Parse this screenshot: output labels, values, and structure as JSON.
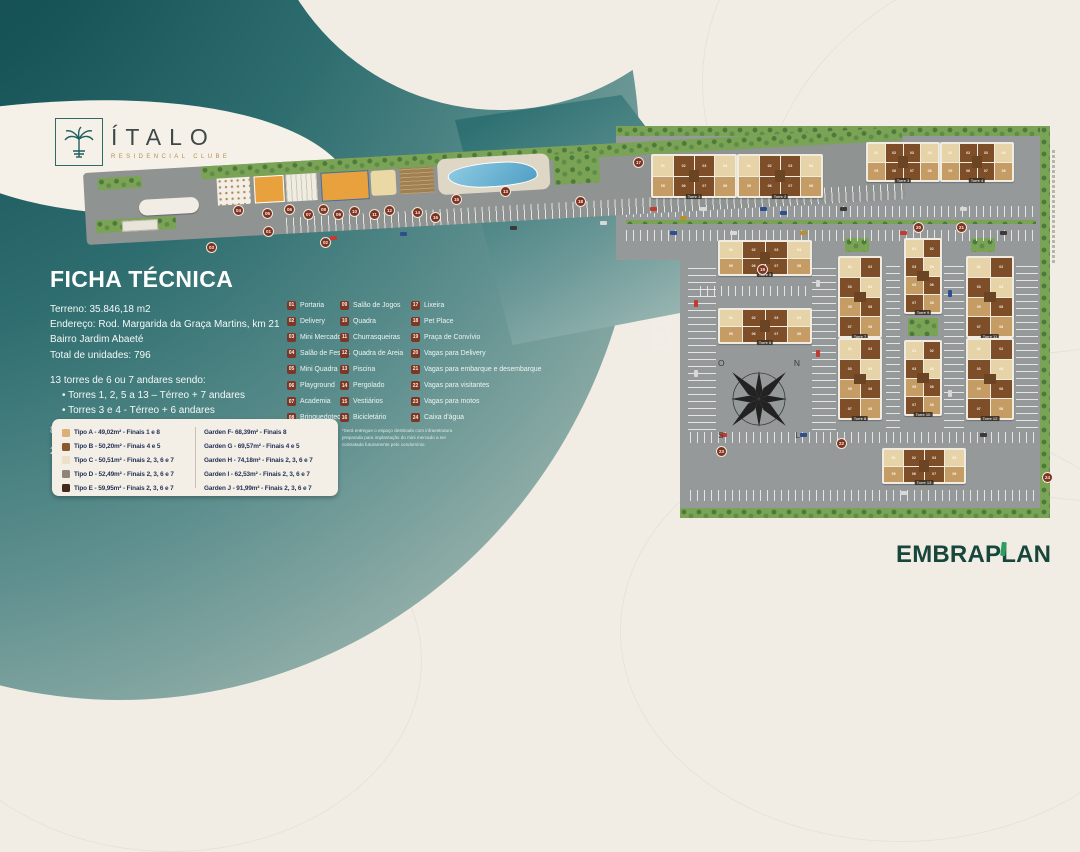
{
  "branding": {
    "title": "ÍTALO",
    "subtitle": "RESIDENCIAL CLUBE",
    "developer": "EMBRAPLAN"
  },
  "watermark": {
    "brand": "SMAGNO",
    "tagline": "Home Br"
  },
  "ficha": {
    "title": "FICHA TÉCNICA",
    "lines": [
      "Terreno: 35.846,18 m2",
      "Endereço: Rod. Margarida da Graça Martins, km 21",
      "Bairro Jardim Abaeté",
      "Total de unidades: 796"
    ],
    "torres_intro": "13 torres de 6 ou 7 andares sendo:",
    "torres_bullets": [
      "Torres 1, 2, 5 a 13 – Térreo + 7 andares",
      "Torres 3 e 4 - Térreo + 6 andares"
    ],
    "extra": [
      "8 unidades por pavimento",
      "2 elevadores por torre"
    ]
  },
  "legend": {
    "col1": [
      [
        "01",
        "Portaria"
      ],
      [
        "02",
        "Delivery"
      ],
      [
        "03",
        "Mini Mercado*"
      ],
      [
        "04",
        "Salão de Festas"
      ],
      [
        "05",
        "Mini Quadra"
      ],
      [
        "06",
        "Playground"
      ],
      [
        "07",
        "Academia"
      ],
      [
        "08",
        "Brinquedoteca"
      ]
    ],
    "col2": [
      [
        "09",
        "Salão de Jogos"
      ],
      [
        "10",
        "Quadra"
      ],
      [
        "11",
        "Churrasqueiras"
      ],
      [
        "12",
        "Quadra de Areia"
      ],
      [
        "13",
        "Piscina"
      ],
      [
        "14",
        "Pergolado"
      ],
      [
        "15",
        "Vestiários"
      ],
      [
        "16",
        "Bicicletário"
      ]
    ],
    "col3": [
      [
        "17",
        "Lixeira"
      ],
      [
        "18",
        "Pet Place"
      ],
      [
        "19",
        "Praça de Convívio"
      ],
      [
        "20",
        "Vagas para Delivery"
      ],
      [
        "21",
        "Vagas para embarque e desembarque"
      ],
      [
        "22",
        "Vagas para visitantes"
      ],
      [
        "23",
        "Vagas para motos"
      ],
      [
        "24",
        "Caixa d'água"
      ]
    ]
  },
  "typologies": {
    "tipos": [
      {
        "color": "#d9b178",
        "label": "Tipo A - 49,02m² - Finais 1 e 8"
      },
      {
        "color": "#8a5a2f",
        "label": "Tipo B - 50,20m² - Finais 4 e 5"
      },
      {
        "color": "#ece0c8",
        "label": "Tipo C - 50,51m² - Finais 2, 3, 6 e 7"
      },
      {
        "color": "#8f8576",
        "label": "Tipo D - 52,49m² - Finais 2, 3, 6 e 7"
      },
      {
        "color": "#45291a",
        "label": "Tipo E - 59,95m² - Finais 2, 3, 6 e 7"
      }
    ],
    "gardens": [
      "Garden F- 68,39m² - Finais 8",
      "Garden G - 69,57m² - Finais 4 e 5",
      "Garden H - 74,18m² - Finais 2, 3, 6 e 7",
      "Garden I - 62,53m² - Finais 2, 3, 6 e 7",
      "Garden J - 91,99m² - Finais 2, 3, 6 e 7"
    ]
  },
  "note": "*Será entregue o espaço destinado com infraestrutura preparada para implantação do mini mercado a ser contratada futuramente pelo condomínio.",
  "compass": {
    "o": "O",
    "n": "N",
    "s": "S",
    "l": "L"
  },
  "plan": {
    "unit_numbers": [
      "01",
      "02",
      "03",
      "04",
      "05",
      "06",
      "07",
      "08"
    ],
    "towers": [
      {
        "label": "Torre 1",
        "x": 651,
        "y": 154,
        "w": 86,
        "h": 44,
        "o": "h"
      },
      {
        "label": "Torre 2",
        "x": 737,
        "y": 154,
        "w": 86,
        "h": 44,
        "o": "h"
      },
      {
        "label": "Torre 3",
        "x": 866,
        "y": 142,
        "w": 74,
        "h": 40,
        "o": "h"
      },
      {
        "label": "Torre 4",
        "x": 940,
        "y": 142,
        "w": 74,
        "h": 40,
        "o": "h"
      },
      {
        "label": "Torre 5",
        "x": 718,
        "y": 240,
        "w": 94,
        "h": 36,
        "o": "h"
      },
      {
        "label": "Torre 6",
        "x": 718,
        "y": 308,
        "w": 94,
        "h": 36,
        "o": "h"
      },
      {
        "label": "Torre 7",
        "x": 838,
        "y": 256,
        "w": 44,
        "h": 82,
        "o": "v"
      },
      {
        "label": "Torre 8",
        "x": 838,
        "y": 338,
        "w": 44,
        "h": 82,
        "o": "v"
      },
      {
        "label": "Torre 9",
        "x": 904,
        "y": 238,
        "w": 38,
        "h": 76,
        "o": "v"
      },
      {
        "label": "Torre 10",
        "x": 904,
        "y": 340,
        "w": 38,
        "h": 76,
        "o": "v"
      },
      {
        "label": "Torre 11",
        "x": 966,
        "y": 256,
        "w": 48,
        "h": 82,
        "o": "v"
      },
      {
        "label": "Torre 12",
        "x": 966,
        "y": 338,
        "w": 48,
        "h": 82,
        "o": "v"
      },
      {
        "label": "Torre 13",
        "x": 882,
        "y": 448,
        "w": 84,
        "h": 36,
        "o": "h"
      }
    ],
    "badges": [
      {
        "n": "01",
        "x": 263,
        "y": 226
      },
      {
        "n": "02",
        "x": 320,
        "y": 237
      },
      {
        "n": "03",
        "x": 206,
        "y": 242
      },
      {
        "n": "04",
        "x": 233,
        "y": 205
      },
      {
        "n": "05",
        "x": 262,
        "y": 208
      },
      {
        "n": "06",
        "x": 284,
        "y": 204
      },
      {
        "n": "07",
        "x": 303,
        "y": 209
      },
      {
        "n": "08",
        "x": 318,
        "y": 204
      },
      {
        "n": "09",
        "x": 333,
        "y": 209
      },
      {
        "n": "10",
        "x": 349,
        "y": 206
      },
      {
        "n": "11",
        "x": 369,
        "y": 209
      },
      {
        "n": "12",
        "x": 384,
        "y": 205
      },
      {
        "n": "13",
        "x": 500,
        "y": 186
      },
      {
        "n": "14",
        "x": 412,
        "y": 207
      },
      {
        "n": "15",
        "x": 451,
        "y": 194
      },
      {
        "n": "16",
        "x": 430,
        "y": 212
      },
      {
        "n": "17",
        "x": 633,
        "y": 157
      },
      {
        "n": "18",
        "x": 575,
        "y": 196
      },
      {
        "n": "19",
        "x": 757,
        "y": 264
      },
      {
        "n": "20",
        "x": 913,
        "y": 222
      },
      {
        "n": "21",
        "x": 956,
        "y": 222
      },
      {
        "n": "22",
        "x": 836,
        "y": 438
      },
      {
        "n": "23",
        "x": 716,
        "y": 446
      },
      {
        "n": "24",
        "x": 1042,
        "y": 472
      }
    ]
  }
}
